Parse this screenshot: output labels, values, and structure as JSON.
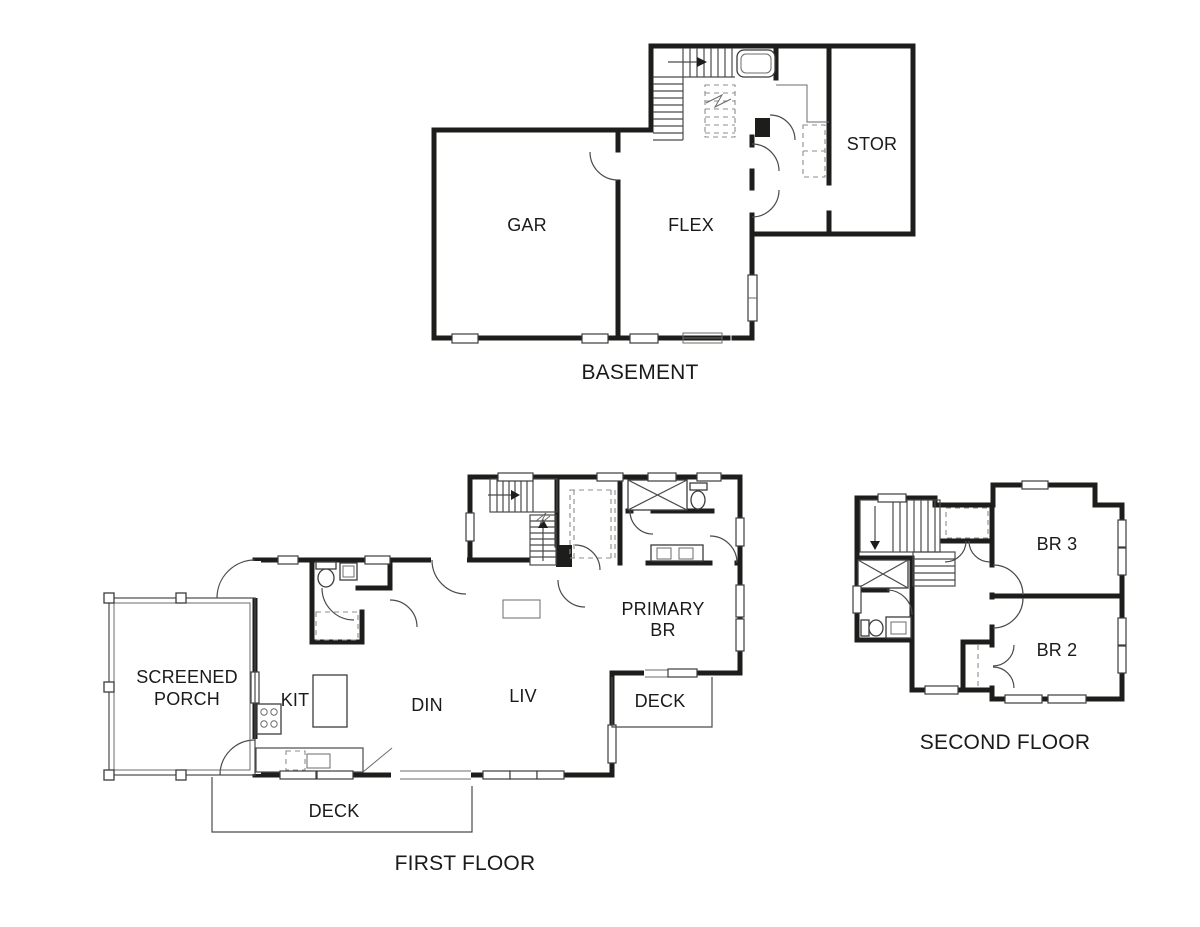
{
  "plans": {
    "basement": {
      "title": "BASEMENT",
      "rooms": {
        "gar": "GAR",
        "flex": "FLEX",
        "stor": "STOR"
      }
    },
    "first_floor": {
      "title": "FIRST FLOOR",
      "rooms": {
        "screened_porch_line1": "SCREENED",
        "screened_porch_line2": "PORCH",
        "kit": "KIT",
        "din": "DIN",
        "liv": "LIV",
        "primary_br_line1": "PRIMARY",
        "primary_br_line2": "BR",
        "deck_front": "DECK",
        "deck_rear": "DECK"
      }
    },
    "second_floor": {
      "title": "SECOND FLOOR",
      "rooms": {
        "br3": "BR 3",
        "br2": "BR 2"
      }
    }
  },
  "colors": {
    "walls": "#1d1d1b",
    "thin_lines": "#4a4a4a",
    "dashed_lines": "#8c8c8c",
    "text": "#1a1a1a",
    "background": "#ffffff"
  }
}
